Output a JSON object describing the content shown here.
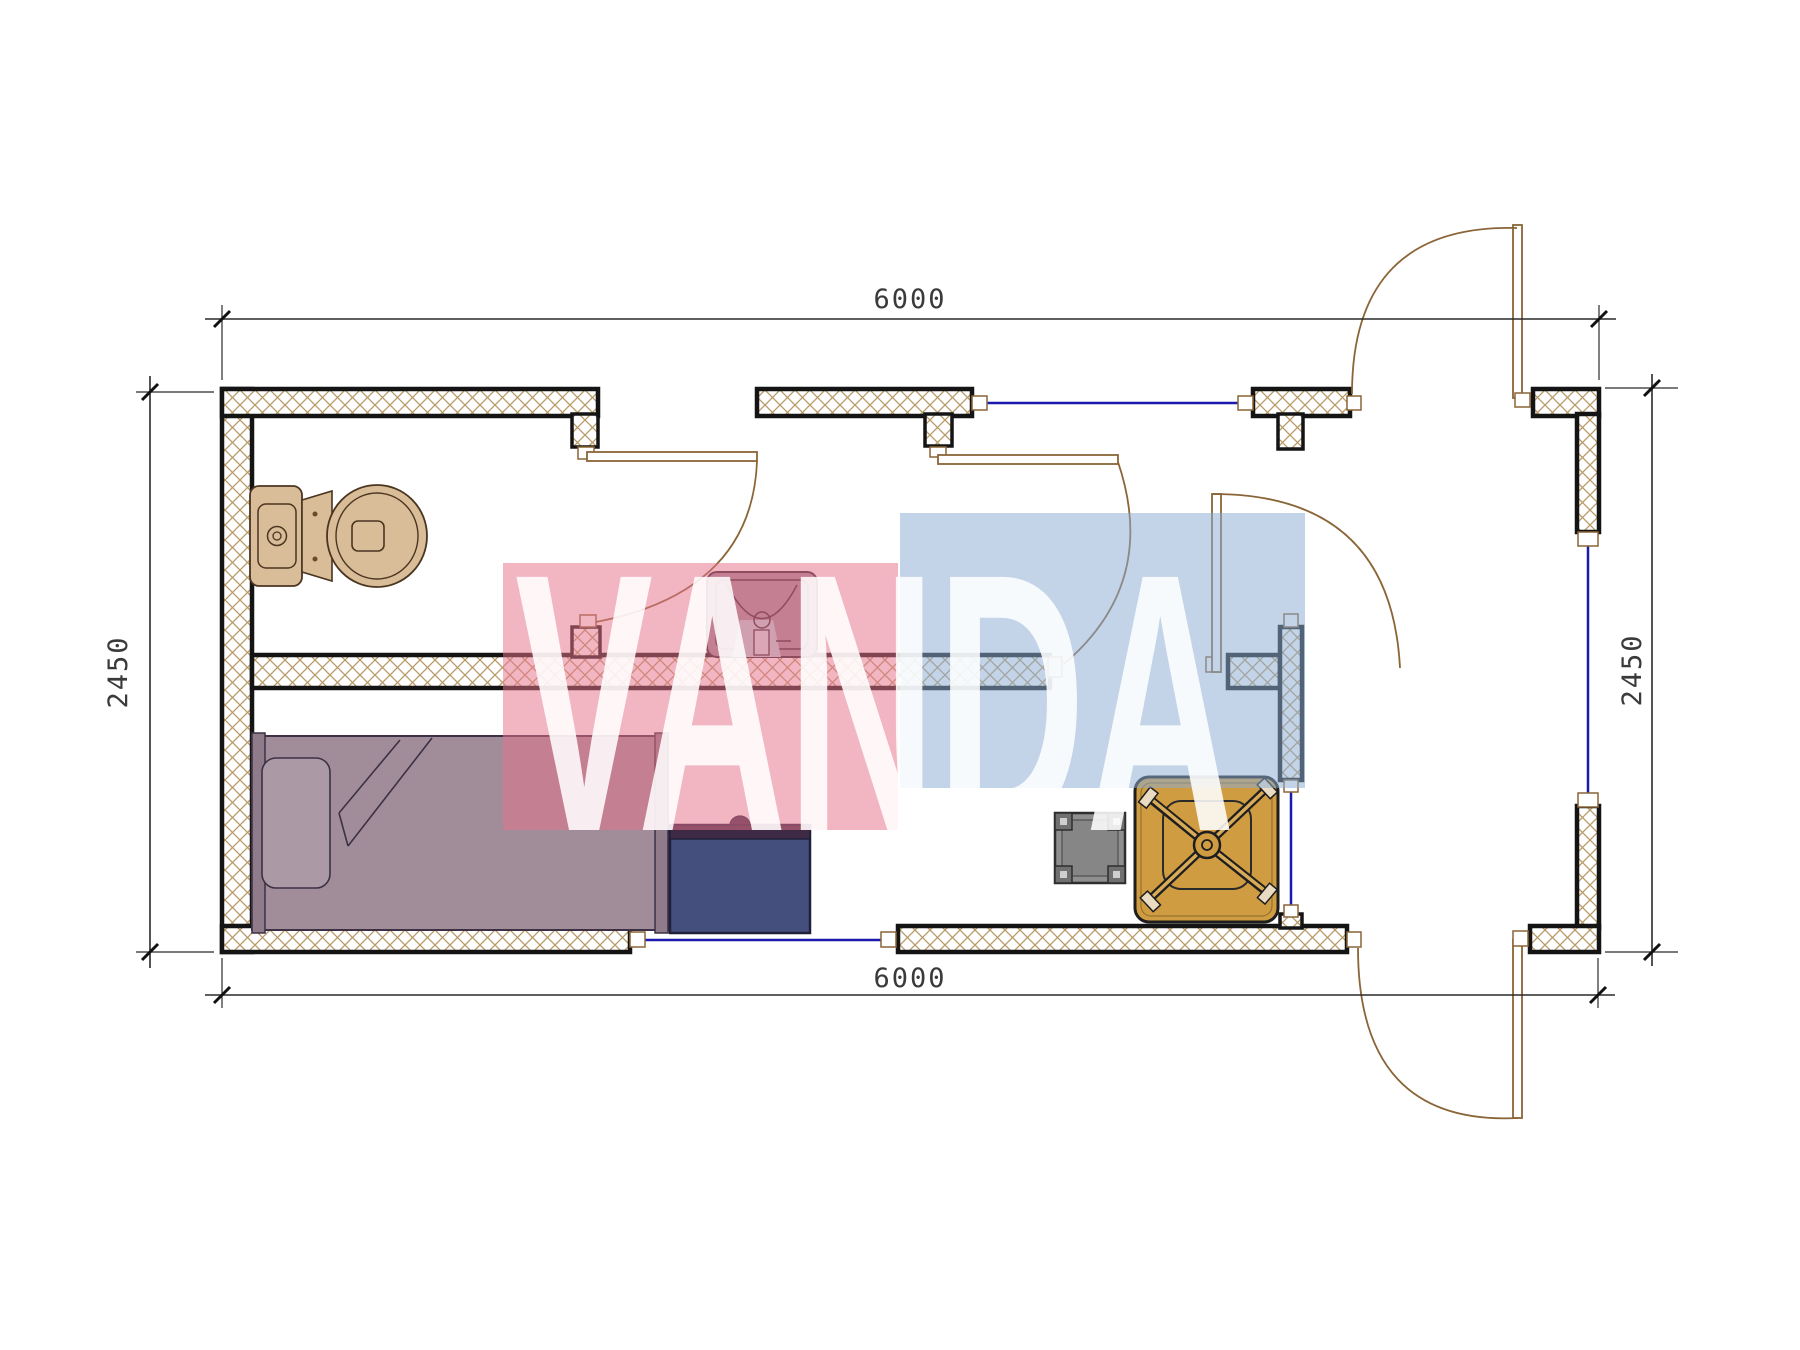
{
  "watermark": {
    "text": "VANDA",
    "pink_color": "#e67390",
    "blue_color": "#8cacd3",
    "text_color": "#ffffff"
  },
  "dimensions": {
    "top": "6000",
    "bottom": "6000",
    "left": "2450",
    "right": "2450"
  },
  "plan": {
    "type": "container-cabin-floor-plan",
    "wall_hatch_color": "#b89a66",
    "wall_border_color": "#141414",
    "window_color": "#1a1aae",
    "door_color": "#8a6537",
    "furniture": [
      {
        "name": "toilet",
        "color": "#d9bd98"
      },
      {
        "name": "washbasin",
        "color": "#a18d9a"
      },
      {
        "name": "single-bed",
        "color": "#a18d9a"
      },
      {
        "name": "desk",
        "color": "#454f7d"
      },
      {
        "name": "stool",
        "color": "#8f8f8f"
      },
      {
        "name": "table-with-office-chair",
        "color": "#cf9c42"
      }
    ]
  }
}
